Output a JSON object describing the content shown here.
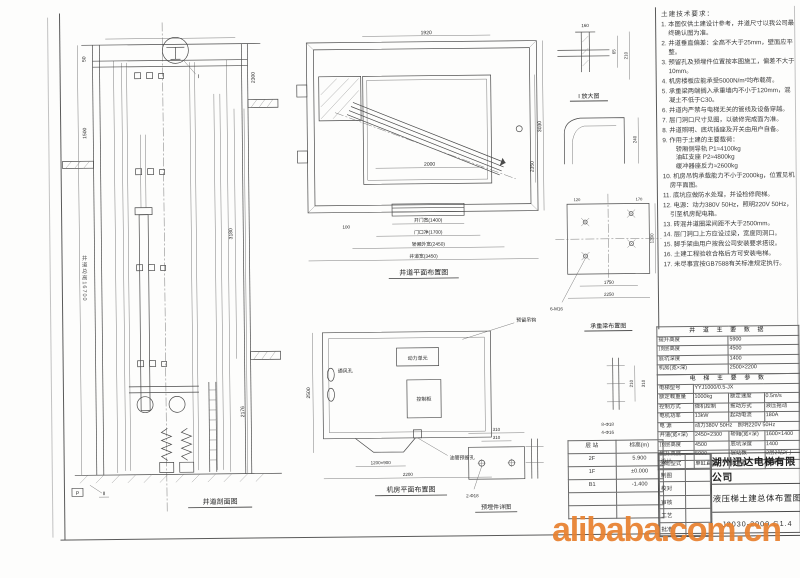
{
  "watermark": "alibaba.com.cn",
  "captions": {
    "elevation": "井道剖面图",
    "plan": "井道平面布置图",
    "machine_room": "机房平面布置图",
    "detail_i": "I 放大图",
    "beam": "承重梁布置图",
    "plate": "预埋件详图"
  },
  "annotations": {
    "pump": "动力单元",
    "cabinet": "控制柜",
    "vent": "通风孔",
    "hook": "预留吊钩",
    "rope_hole": "油管预留孔",
    "shaft_total": "井道总高16700"
  },
  "dims": {
    "elev": {
      "top_left": "50",
      "left": "1500",
      "top_right": "2300",
      "right_mid": "3180",
      "right_low": "2176",
      "marker_p": "P",
      "marker_ii": "II",
      "callout_i": "I"
    },
    "plan": {
      "top": "1920",
      "right_outer": "3030",
      "right_inner": "2350",
      "inner_depth": "2000",
      "left_small": "100",
      "chains": [
        "开门宽(1400)",
        "门口净(1700)",
        "轿厢外宽(2450)",
        "井道宽(3450)"
      ]
    },
    "mr": {
      "left": "2500",
      "bottom_inner": "1200×900",
      "bottom": "2200"
    },
    "beam": {
      "w1": "1750",
      "w2": "2250",
      "t1": "120",
      "t2": "170",
      "h": "1200",
      "bolts": "6-M16"
    },
    "plate": {
      "d1": "310",
      "d2": "310",
      "bolts": "2-Φ18"
    },
    "strip": {
      "d1": "210",
      "d2": "310",
      "l1": "8-Φ18",
      "l2": "4-Φ16"
    },
    "det1": {
      "d1": "160",
      "d2": "65",
      "d3": "210"
    },
    "det2": {
      "d1": "240"
    }
  },
  "notes": {
    "title": "土建技术要求：",
    "items": [
      "1. 本图仅供土建设计参考，井道尺寸以我公司最终确认图为准。",
      "2. 井道垂直偏差：全高不大于25mm，壁面应平整。",
      "3. 预留孔及预埋件位置按本图施工，偏差不大于10mm。",
      "4. 机房楼板应能承受5000N/m²均布载荷。",
      "5. 承重梁两端搁入承重墙内不小于120mm，混凝土不低于C30。",
      "6. 井道内严禁与电梯无关的管线及设备穿越。",
      "7. 层门洞口尺寸见图，以装修完成面为准。",
      "8. 井道照明、底坑插座及开关由用户自备。",
      "9. 作用于土建的主要载荷：\n　轿厢侧导轨 P1≈4100kg\n　油缸支座 P2≈4800kg\n　缓冲器座反力≈2600kg",
      "10. 机房吊钩承载能力不小于2000kg，位置见机房平面图。",
      "11. 底坑应做防水处理，并设检修爬梯。",
      "12. 电源：动力380V 50Hz，照明220V 50Hz，引至机房配电箱。",
      "13. 砖混井道圈梁间距不大于2500mm。",
      "14. 层门洞口上方应设过梁，宽度同洞口。",
      "15. 脚手架由用户按我公司安装要求搭设。",
      "16. 土建工程验收合格后方可安装电梯。",
      "17. 未尽事宜按GB7588有关标准规定执行。"
    ]
  },
  "spec_top": {
    "title": "井 道 主 要 数 据",
    "rows": [
      [
        "提升高度",
        "5900"
      ],
      [
        "顶层高度",
        "4500"
      ],
      [
        "底坑深度",
        "1400"
      ],
      [
        "机房(宽×深)",
        "2500×2200"
      ]
    ]
  },
  "spec_main": {
    "title": "电 梯 主 要 参 数",
    "rows": [
      [
        "电梯型号",
        "YYJ1000/0.5-JX"
      ],
      [
        "额定载重量",
        "1000kg",
        "额定速度",
        "0.5m/s"
      ],
      [
        "控制方式",
        "微机控制",
        "拖动方式",
        "液压拖动"
      ],
      [
        "电机功率",
        "13kW",
        "起动电流",
        "180A"
      ],
      [
        "电 源",
        "动力380V 50Hz　照明220V 50Hz"
      ],
      [
        "井道(宽×深)",
        "2450×2300",
        "轿厢(宽×深)",
        "1600×1400"
      ],
      [
        "顶层高度",
        "4500",
        "底坑深度",
        "1400"
      ],
      [
        "提升高度",
        "5900",
        "层站数",
        "2层2站2门"
      ],
      [
        "油缸型式",
        "单缸直顶",
        "缓冲器",
        "弹簧式"
      ]
    ]
  },
  "floors_table": {
    "rows": [
      [
        "层 站",
        "标高(m)"
      ],
      [
        "2F",
        "5.900"
      ],
      [
        "1F",
        "±0.000"
      ],
      [
        "B1",
        "-1.400"
      ],
      [
        "",
        ""
      ],
      [
        "",
        ""
      ]
    ]
  },
  "titleblock": {
    "company": "湖州迅达电梯有限公司",
    "title": "液压梯土建总体布置图",
    "number": "J2030-2000 G1.4",
    "left_rows": [
      [
        "设计",
        ""
      ],
      [
        "制图",
        ""
      ],
      [
        "校对",
        ""
      ],
      [
        "审核",
        ""
      ],
      [
        "工艺",
        ""
      ],
      [
        "批准",
        ""
      ]
    ]
  }
}
